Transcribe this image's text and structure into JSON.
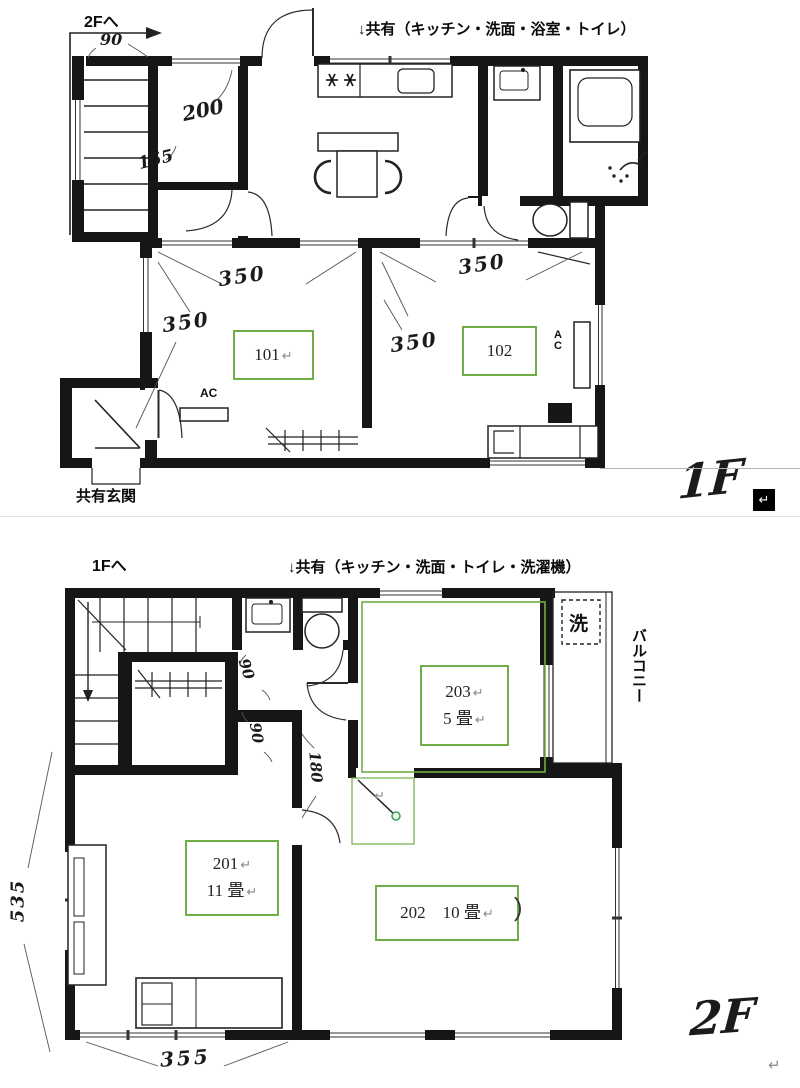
{
  "marks": {
    "pilcrow": "↵"
  },
  "colors": {
    "wall": "#161616",
    "label_green": "#6FAD47",
    "selection_green": "#3aa055"
  },
  "floor1": {
    "nav": "2Fへ",
    "shared": "↓共有（キッチン・洗面・浴室・トイレ）",
    "entrance": "共有玄関",
    "mark": "1F",
    "room101": "101",
    "room102": "102",
    "ac": "AC",
    "ac_vertical": "A\nC",
    "dims": {
      "d90": "90",
      "d200": "200",
      "d155": "155",
      "d350": "350"
    }
  },
  "floor2": {
    "nav": "1Fへ",
    "shared": "↓共有（キッチン・洗面・トイレ・洗濯機）",
    "mark": "2F",
    "washer": "洗",
    "balcony": "バルコニー",
    "paren": "）",
    "room201_no": "201",
    "room201_size": "11 畳",
    "room202": "202　10 畳",
    "room203_no": "203",
    "room203_size": "5 畳",
    "dims": {
      "d90": "90",
      "d180": "180",
      "d535": "535",
      "d355": "355"
    }
  }
}
